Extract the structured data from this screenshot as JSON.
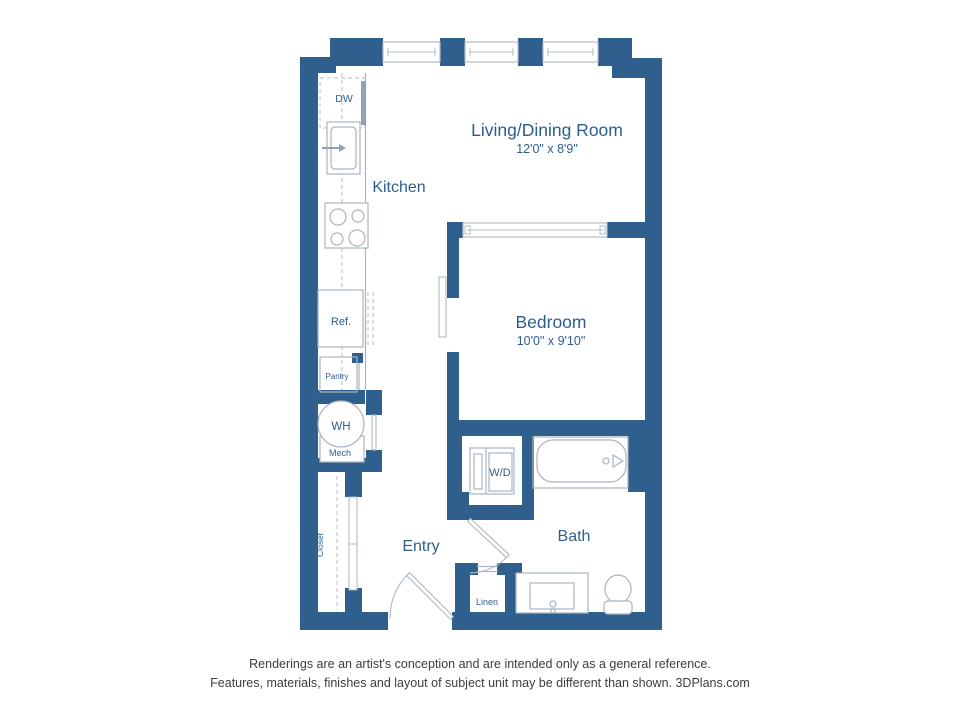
{
  "plan": {
    "living": {
      "label": "Living/Dining Room",
      "dims": "12'0\" x 8'9\""
    },
    "kitchen": {
      "label": "Kitchen"
    },
    "bedroom": {
      "label": "Bedroom",
      "dims": "10'0\" x 9'10\""
    },
    "entry": {
      "label": "Entry"
    },
    "bath": {
      "label": "Bath"
    },
    "closet": {
      "label": "Closet"
    },
    "appliances": {
      "dw": "DW",
      "ref": "Ref.",
      "pantry": "Pantry",
      "wh": "WH",
      "mech": "Mech",
      "wd": "W/D",
      "linen": "Linen"
    }
  },
  "footer": {
    "line1": "Renderings are an artist's conception and are intended only as a general reference.",
    "line2": "Features, materials, finishes and layout of subject unit may be different than shown. 3DPlans.com"
  },
  "colors": {
    "wall": "#2f5f8d",
    "room_label": "#2d5f8e",
    "fixture_outline": "#a9b4c0",
    "footer_text": "#3d3d3d",
    "background": "#ffffff"
  }
}
